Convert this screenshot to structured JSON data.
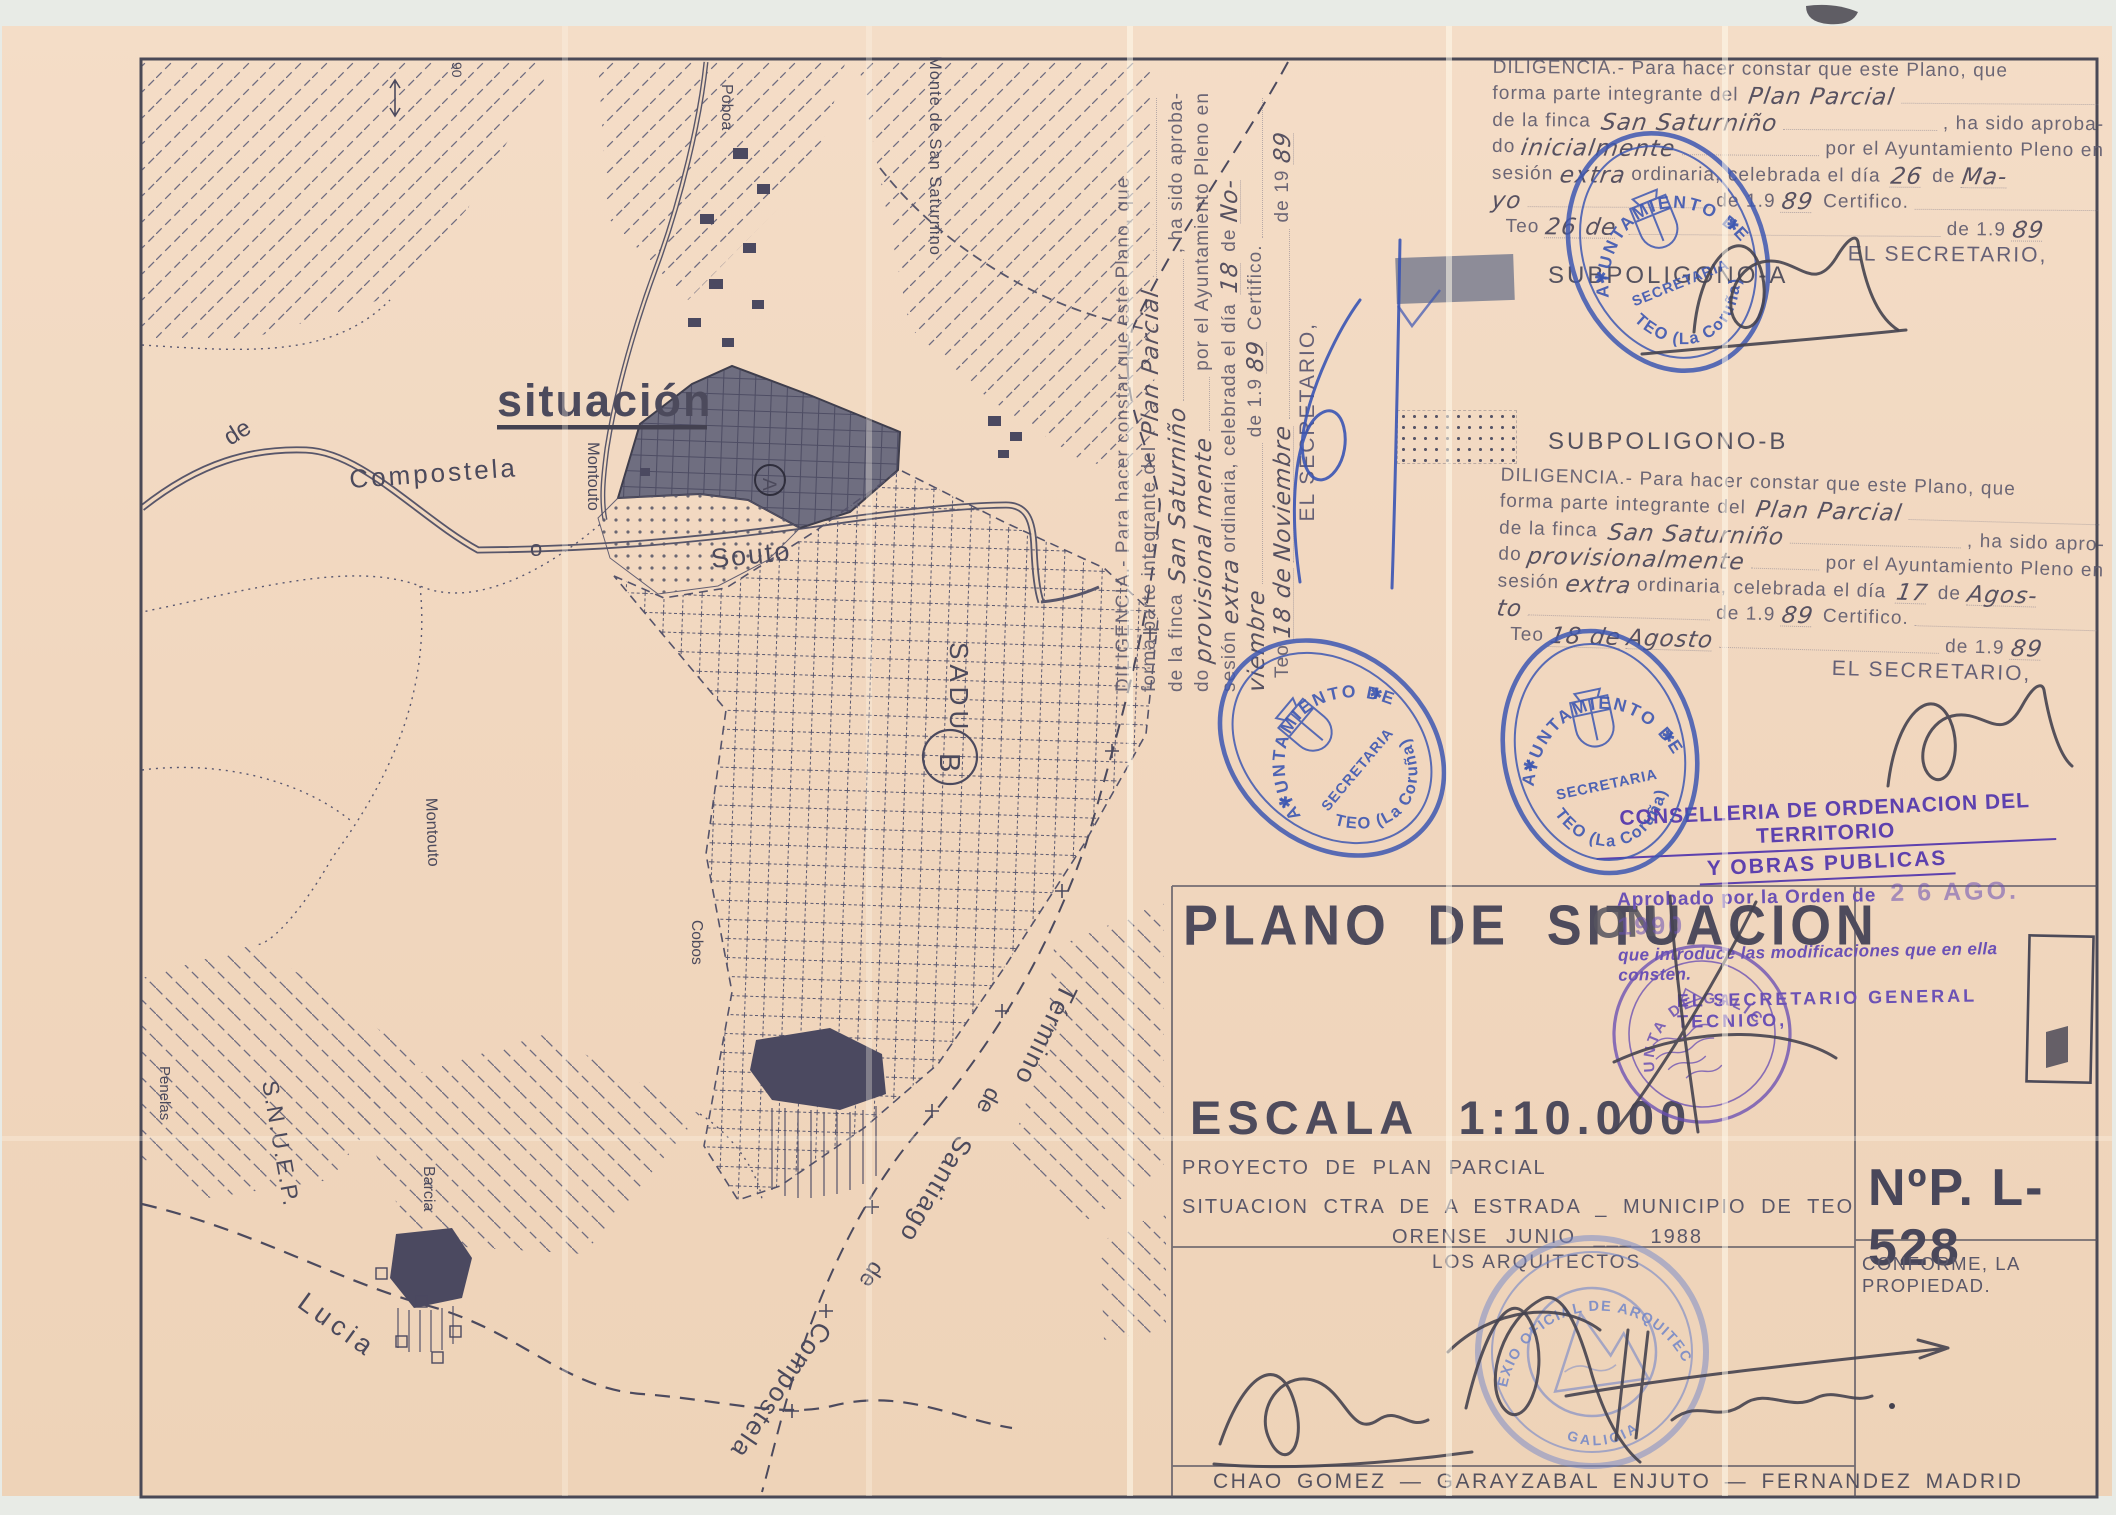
{
  "scan": {
    "corner_mark": "90"
  },
  "map": {
    "labels": {
      "situacion": "situación",
      "de": "de",
      "compostela": "Compostela",
      "montouto_a": "Montouto",
      "montouto_b": "Montouto",
      "o": "o",
      "poboa": "Poboa",
      "monte_san_saturnino": "Monte de San Saturnino",
      "souto": "Souto",
      "sadu": "SADU",
      "circle_a": "A",
      "circle_b": "B",
      "cobos": "Cobos",
      "penelas": "Penelas",
      "snuep": "S.N.U.E.P.",
      "barcia": "Barcia",
      "lucia": "Lucia",
      "termino": "Término",
      "termino_de1": "de",
      "santiago": "Santiago",
      "termino_de2": "de",
      "compostela_2": "Compostela"
    }
  },
  "legend": {
    "subpoligono_a": "SUBPOLIGONO-A",
    "subpoligono_b": "SUBPOLIGONO-B"
  },
  "diligencias": {
    "top": {
      "l1": "DILIGENCIA.- Para hacer constar que este Plano, que",
      "l2a": "forma parte integrante del",
      "l2b": "Plan Parcial",
      "l3a": "de la finca",
      "l3b": "San Saturniño",
      "l3c": ", ha sido aproba-",
      "l4a": "do",
      "l4b": "inicialmente",
      "l4c": "por el Ayuntamiento Pleno en",
      "l5a": "sesión",
      "l5b": "extra",
      "l5c": "ordinaria, celebrada el día",
      "l5d": "26",
      "l5e": "de",
      "l5f": "Ma-",
      "l6a": "yo",
      "l6b": "de 1.9",
      "l6c": "89",
      "l6d": "Certifico.",
      "l7a": "Teo",
      "l7b": "26 de",
      "l7c": "",
      "l7d": "de 1.9",
      "l7e": "89",
      "l8": "EL SECRETARIO,"
    },
    "middle": {
      "l1": "DILIGENCIA.- Para hacer constar que este Plano, que",
      "l2a": "forma parte integrante del",
      "l2b": "Plan Parcial",
      "l3a": "de la finca",
      "l3b": "San Saturniño",
      "l3c": ", ha sido apro-",
      "l4a": "do",
      "l4b": "provisionalmente",
      "l4c": "por el Ayuntamiento Pleno en",
      "l5a": "sesión",
      "l5b": "extra",
      "l5c": "ordinaria, celebrada el día",
      "l5d": "17",
      "l5e": "de",
      "l5f": "Agos-",
      "l6a": "to",
      "l6b": "de 1.9",
      "l6c": "89",
      "l6d": "Certifico.",
      "l7a": "Teo",
      "l7b": "18 de",
      "l7c": "Agosto",
      "l7d": "de 1.9",
      "l7e": "89",
      "l8": "EL SECRETARIO,"
    },
    "side": {
      "l1": "DILIGENCIA.- Para hacer constar que este Plano, que",
      "l2a": "forma parte integrante del",
      "l2b": "Plan Parcial",
      "l3a": "de la finca",
      "l3b": "San Saturniño",
      "l3c": ", ha sido aproba-",
      "l4a": "do",
      "l4b": "provisional mente",
      "l4c": "por el Ayuntamiento Pleno en",
      "l5a": "sesión",
      "l5b": "extra",
      "l5c": "ordinaria, celebrada el día",
      "l5d": "18",
      "l5e": "de",
      "l5f": "No-",
      "l6a": "viembre",
      "l6b": "de 1.9",
      "l6c": "89",
      "l6d": "Certifico.",
      "l7a": "Teo",
      "l7b": "18 de",
      "l7c": "Noviembre",
      "l7d": "de 19",
      "l7e": "89",
      "l8": "EL SECRETARIO,"
    }
  },
  "stamps": {
    "ayuntamiento": {
      "arc_top": "AYUNTAMIENTO DE",
      "arc_bottom": "TEO (La Coruña)",
      "band": "SECRETARIA",
      "star_left": "✱",
      "star_right": "✱"
    },
    "conselleria": {
      "line1": "CONSELLERIA DE ORDENACION DEL TERRITORIO",
      "line2": "Y OBRAS PUBLICAS"
    },
    "aprobado": {
      "intro": "Aprobado por la Orden de",
      "date": "2 6 AGO. 1990",
      "line2": "que introduce las modificaciones que en ella consten.",
      "line3": "EL SECRETARIO GENERAL TECNICO,",
      "bleed_text": "ON"
    },
    "xunta": {
      "arc": "XUNTA DE GALICIA"
    },
    "arquitectos": {
      "arc_top": "COLEXIO OFICIAL DE ARQUITECTOS",
      "arc_bottom": "GALICIA"
    }
  },
  "title_block": {
    "title": "PLANO DE SITUACION",
    "scale": "ESCALA 1:10.000",
    "project": "PROYECTO DE PLAN PARCIAL",
    "situation": "SITUACION CTRA DE A ESTRADA _ MUNICIPIO DE TEO",
    "date_line": "ORENSE JUNIO ___ 1988",
    "architects_label": "LOS ARQUITECTOS",
    "number": "NºP. L-528",
    "conforme": "CONFORME, LA PROPIEDAD.",
    "architects_names": "CHAO GOMEZ — GARAYZABAL ENJUTO — FERNANDEZ MADRID"
  },
  "colors": {
    "paper": "#f1d8bf",
    "ink": "#55525f",
    "stamp_blue": "#3d57b2",
    "stamp_purple": "#6a50b4"
  }
}
